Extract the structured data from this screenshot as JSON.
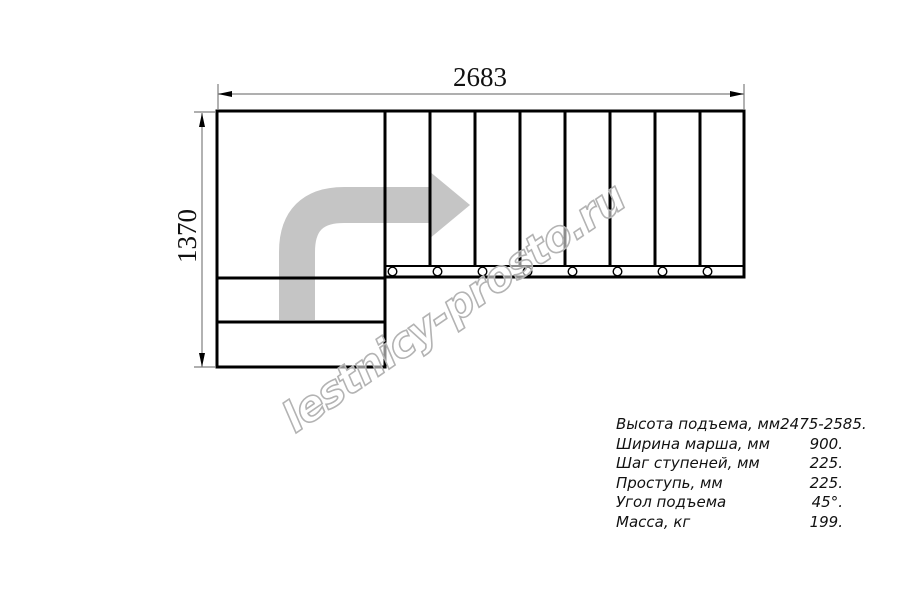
{
  "drawing": {
    "width_dimension_label": "2683",
    "height_dimension_label": "1370",
    "watermark_text": "lestnicy-prosto.ru",
    "colors": {
      "line": "#000000",
      "dimension_line": "#7f7f7f",
      "arrow_fill": "#c5c5c5",
      "watermark_outline": "#b3b3b3"
    },
    "icons": {
      "direction_arrow": "curved-right-arrow"
    },
    "step_circle_count": 8
  },
  "specs": {
    "rows": [
      {
        "label": "Высота подъема, мм",
        "value": "2475-2585."
      },
      {
        "label": "Ширина марша, мм",
        "value": "900."
      },
      {
        "label": "Шаг ступеней, мм",
        "value": "225."
      },
      {
        "label": "Проступь, мм",
        "value": "225."
      },
      {
        "label": "Угол подъема",
        "value": "45°."
      },
      {
        "label": "Масса, кг",
        "value": "199."
      }
    ]
  }
}
